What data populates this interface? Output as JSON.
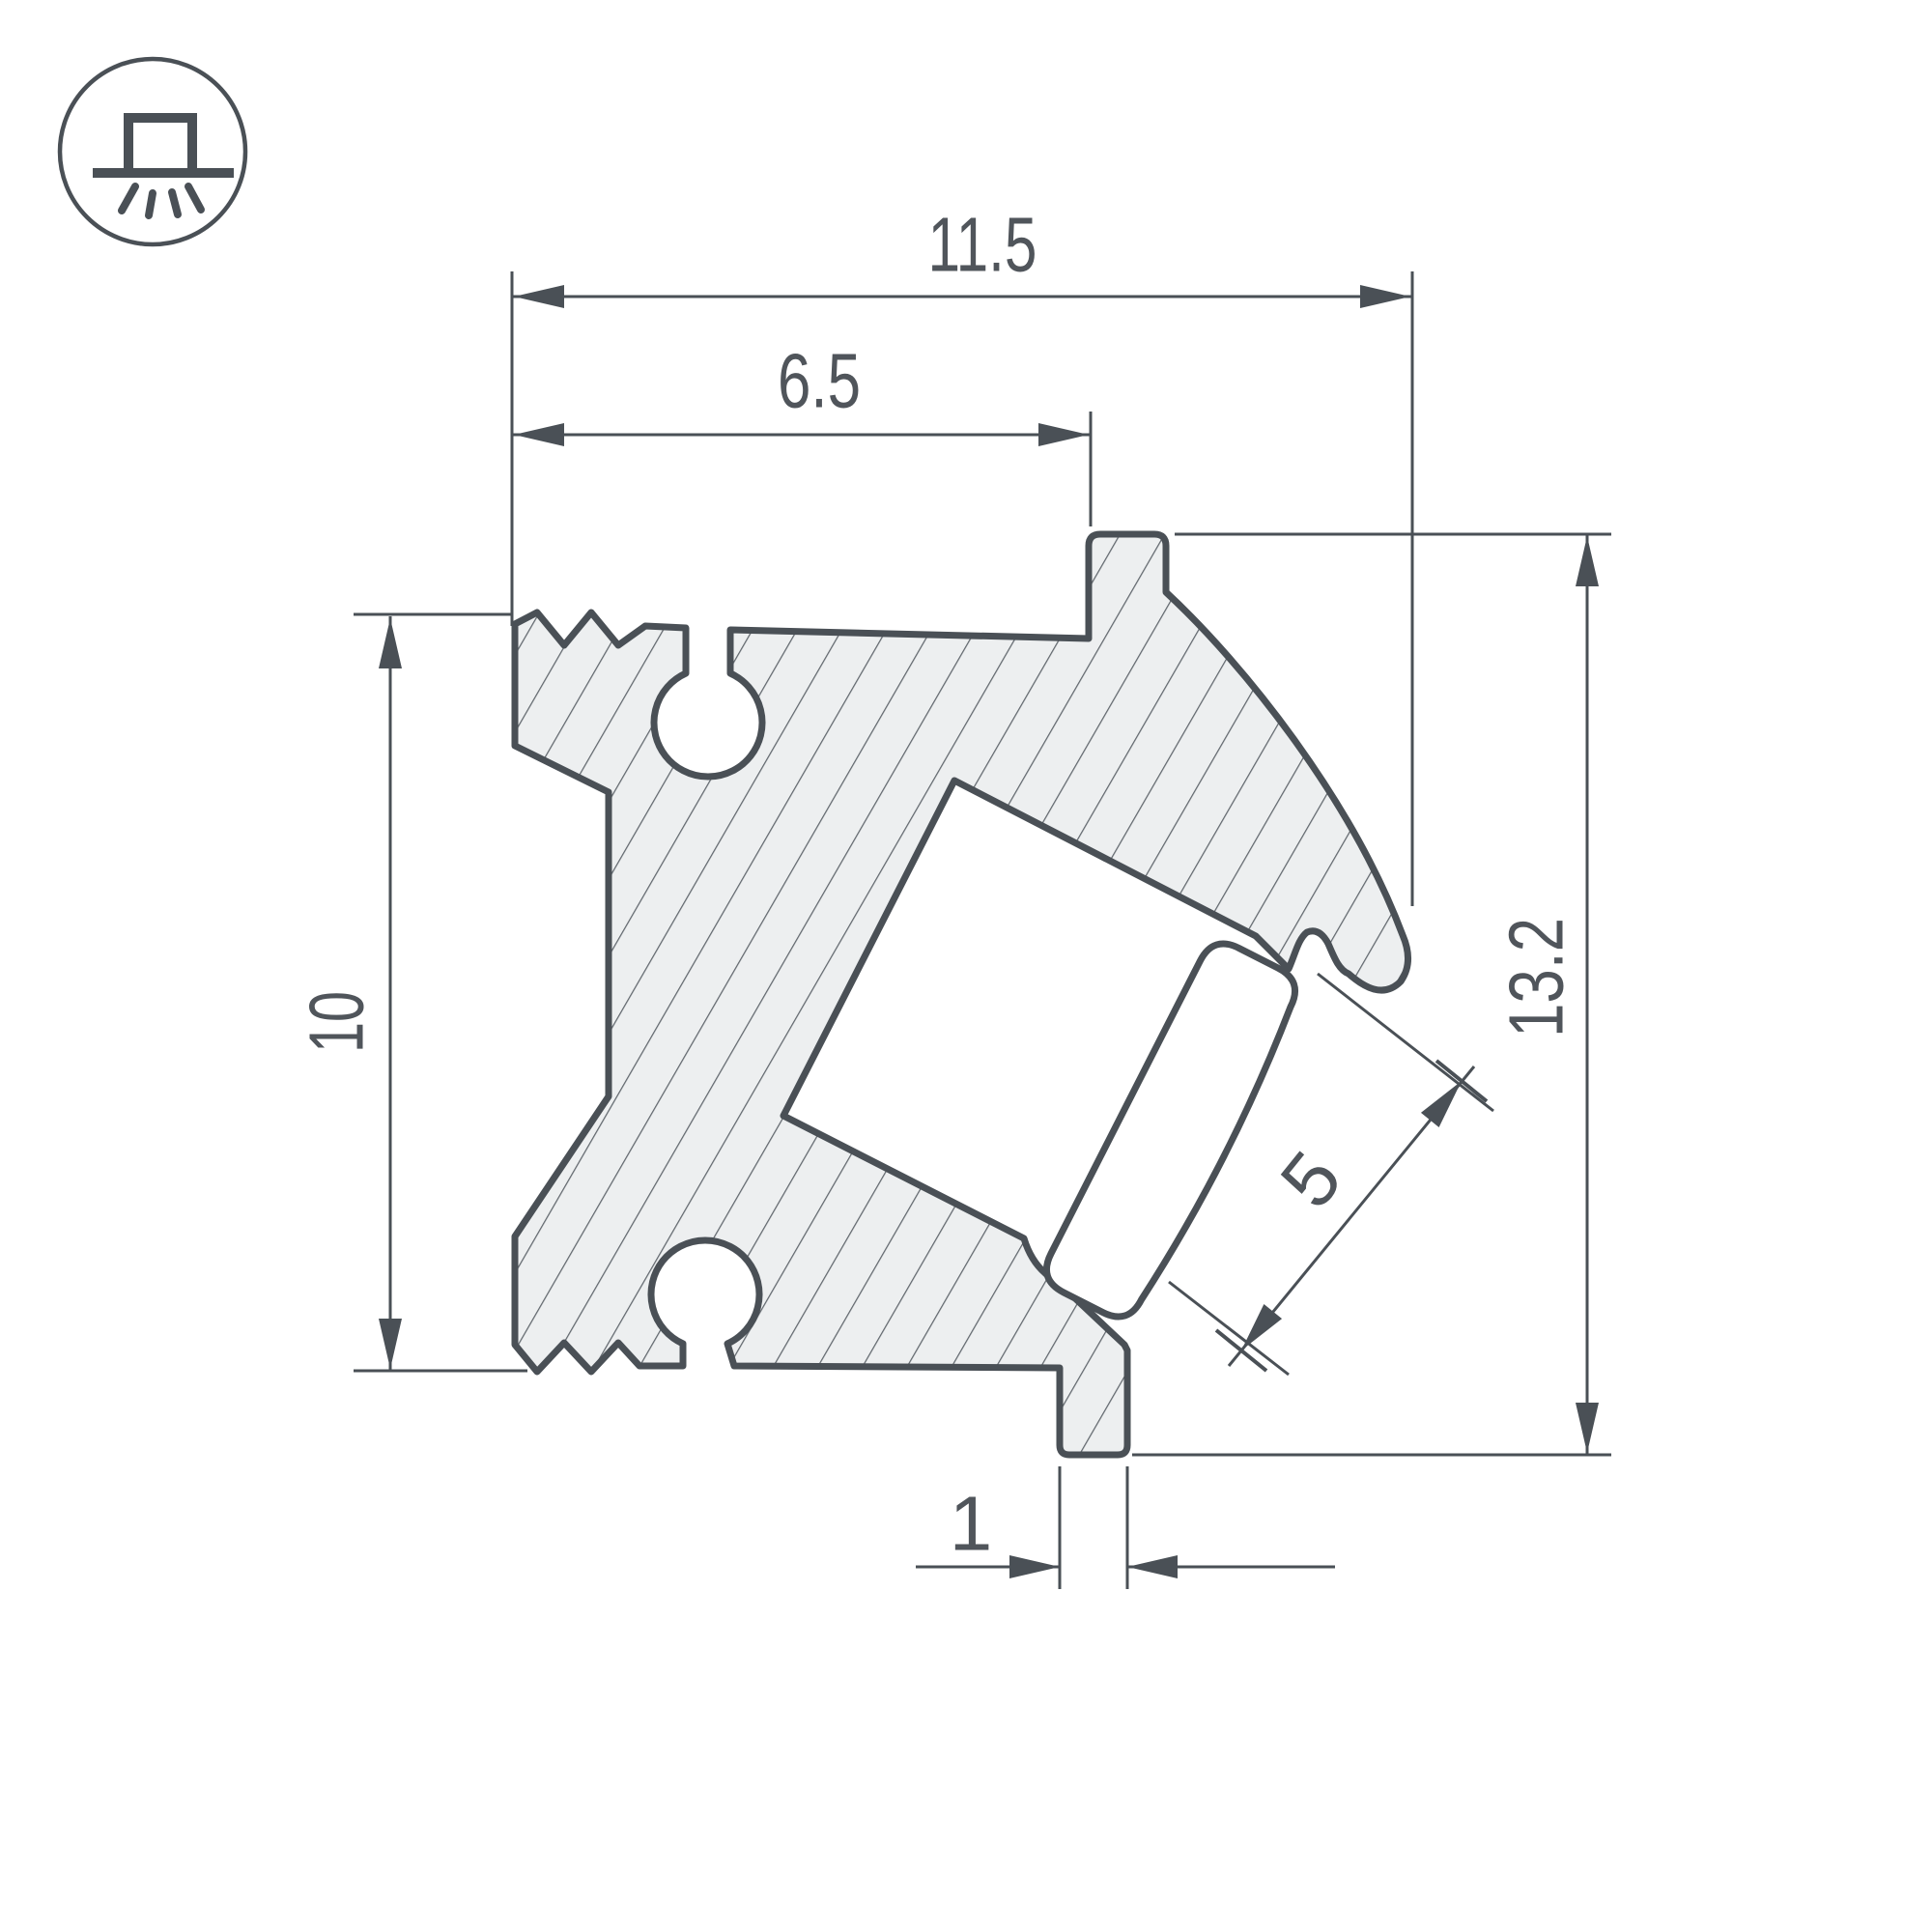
{
  "drawing": {
    "kind": "led-profile-cross-section"
  },
  "icon": {
    "name": "surface-mount-light-icon"
  },
  "dimensions": {
    "top_width": "11.5",
    "inner_width": "6.5",
    "left_height": "10",
    "right_height": "13.2",
    "led_opening": "5",
    "foot_width": "1"
  },
  "colors": {
    "background": "#ffffff",
    "line": "#4a5056",
    "text": "#50555b",
    "body_fill": "#edeff0",
    "hatch": "#61676d",
    "lens_fill": "#ffffff"
  }
}
